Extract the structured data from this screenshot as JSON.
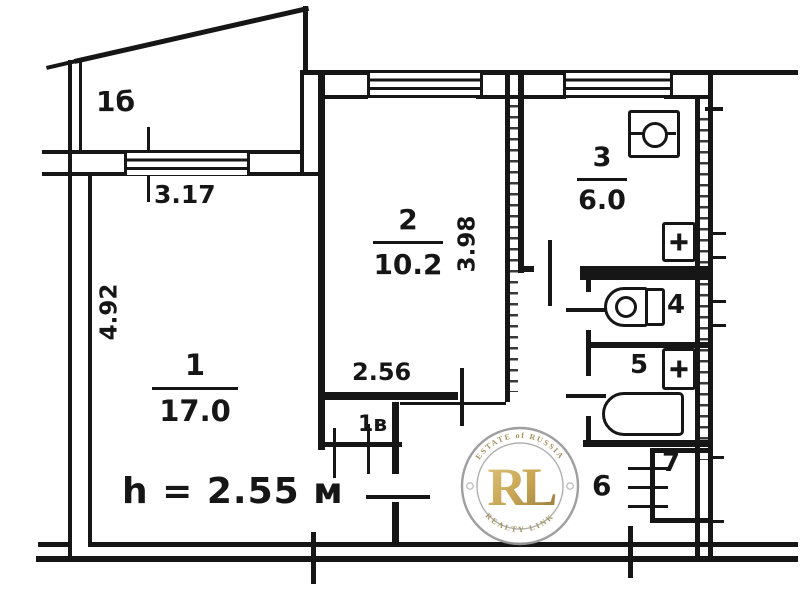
{
  "plan": {
    "ink": "#161616",
    "balcony": {
      "label": "1б",
      "width_dim": "3.17"
    },
    "room1": {
      "number": "1",
      "area": "17.0",
      "depth_dim": "4.92",
      "ceiling_note": "h = 2.55 м"
    },
    "room2": {
      "number": "2",
      "area": "10.2",
      "depth_dim": "3.98",
      "width_dim": "2.56",
      "closet_label": "1в"
    },
    "kitchen": {
      "number": "3",
      "area": "6.0"
    },
    "wc": {
      "number": "4"
    },
    "bathroom": {
      "number": "5"
    },
    "hallway": {
      "number": "6"
    },
    "closet7": {
      "number": "7"
    }
  },
  "watermark": {
    "arc_top": "ESTATE of RUSSIA",
    "monogram": "RL",
    "arc_bottom": "REALTY LINK",
    "gold": "#c6a24b",
    "ring": "#9a9a9a"
  }
}
